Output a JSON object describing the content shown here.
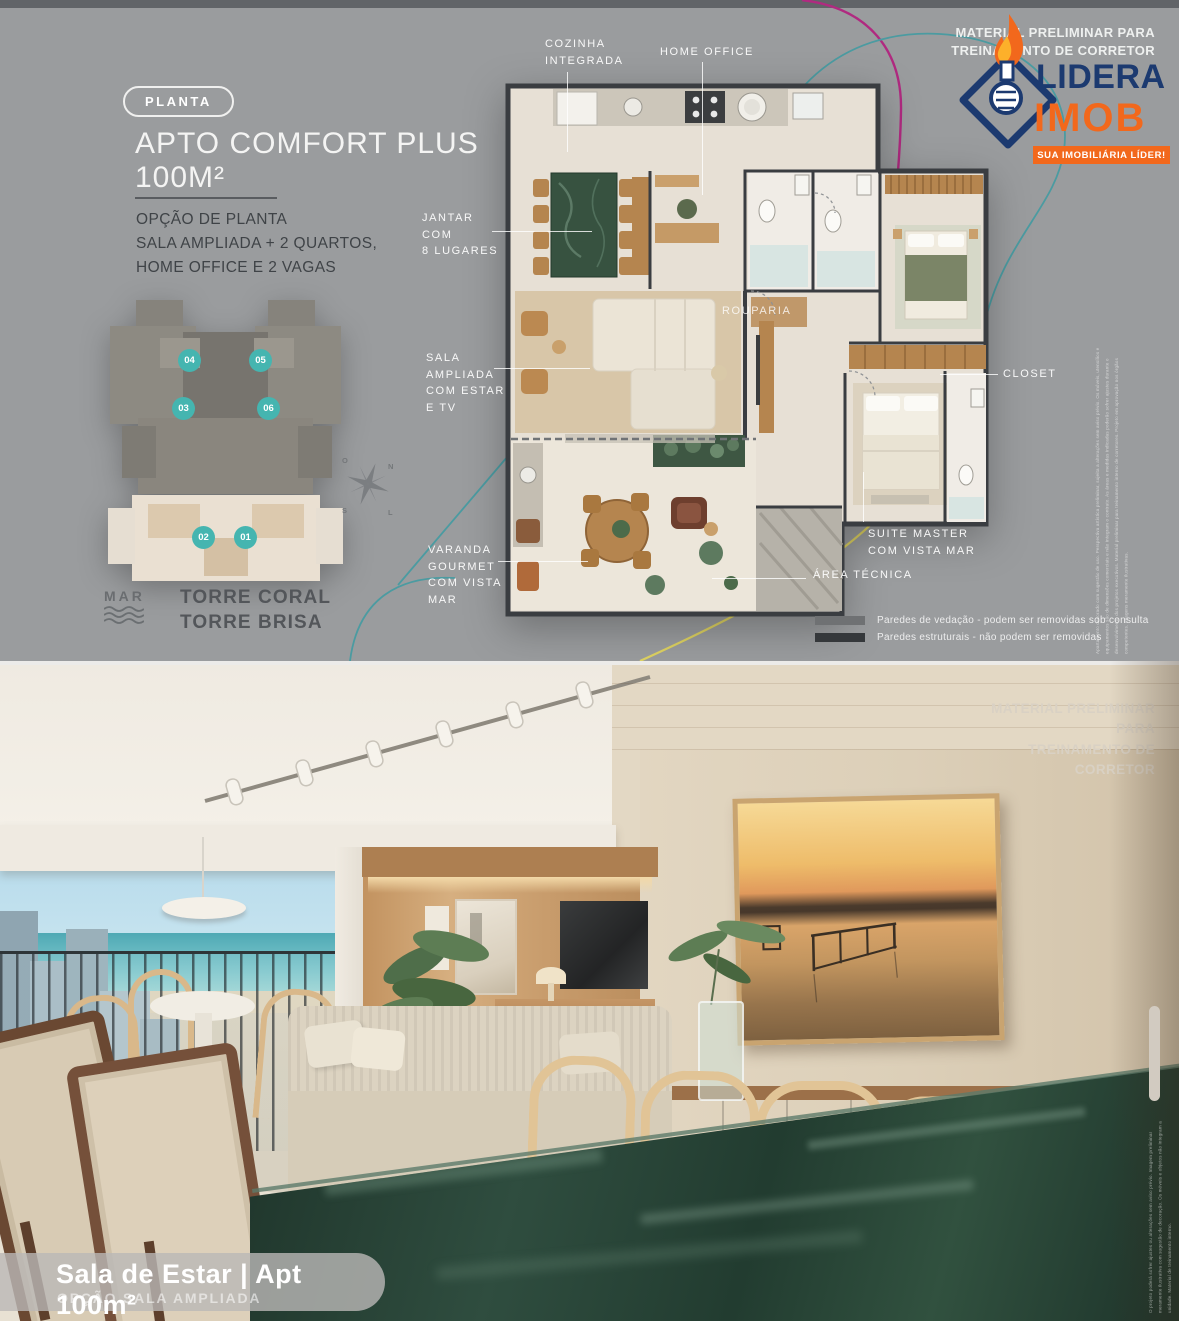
{
  "colors": {
    "background_gray": "#9a9c9e",
    "accent_teal_badge": "#45b5b0",
    "deco_line_teal": "#4b9ba1",
    "deco_line_magenta": "#b02a80",
    "deco_line_yellow": "#ded261",
    "logo_navy": "#1c3a70",
    "logo_orange": "#f2681c",
    "plan_wall_dark": "#3a3d41",
    "marble_green": "#37523f"
  },
  "top": {
    "badge": "PLANTA",
    "title": "APTO COMFORT PLUS",
    "area": "100M²",
    "subtitle": "OPÇÃO DE PLANTA\nSALA AMPLIADA + 2 QUARTOS,\nHOME OFFICE E 2 VAGAS",
    "watermark": "MATERIAL PRELIMINAR PARA\nTREINAMENTO DE CORRETOR",
    "logo": {
      "name_top": "LIDERA",
      "name_bottom": "IMOB",
      "tagline": "SUA IMOBILIÁRIA LÍDER!"
    },
    "tower": {
      "mar": "MAR",
      "names": "TORRE CORAL\nTORRE BRISA",
      "units": [
        "04",
        "05",
        "03",
        "06",
        "02",
        "01"
      ],
      "badge_color": "#45b5b0"
    },
    "compass": {
      "n": "N",
      "s": "S",
      "l": "L",
      "o": "O"
    },
    "plan_labels": {
      "cozinha": "COZINHA\nINTEGRADA",
      "home_office": "HOME OFFICE",
      "jantar": "JANTAR\nCOM\n8 LUGARES",
      "sala": "SALA\nAMPLIADA\nCOM ESTAR\nE TV",
      "varanda": "VARANDA\nGOURMET\nCOM VISTA\nMAR",
      "rouparia": "ROUPARIA",
      "closet": "CLOSET",
      "suite": "SUITE MASTER\nCOM VISTA MAR",
      "area_tecnica": "ÁREA TÉCNICA"
    },
    "legend": [
      {
        "color": "#6f7173",
        "text": "Paredes de vedação - podem ser removidas sob consulta"
      },
      {
        "color": "#35383b",
        "text": "Paredes estruturais - não podem ser removidas"
      }
    ],
    "fine_print": "Apartamento decorado com sugestão de uso. Perspectiva artística preliminar, sujeita a alterações sem aviso prévio. Os móveis, utensílios e equipamentos são de dimensões comerciais e não integram o contrato. As áreas e medidas indicadas poderão sofrer ajustes durante o desenvolvimento dos projetos executivos. Material preliminar para treinamento interno de corretores. Projeto em aprovação nos órgãos competentes. Imagens meramente ilustrativas."
  },
  "bottom": {
    "watermark": "MATERIAL PRELIMINAR PARA\nTREINAMENTO DE CORRETOR",
    "caption": {
      "title": "Sala de Estar |  Apt 100m²",
      "subtitle": "OPÇÃO SALA AMPLIADA"
    },
    "fine_print": "O projeto poderá sofrer ajustes ou alterações sem aviso prévio. Imagem preliminar meramente ilustrativa com sugestão de decoração. Os móveis e objetos não integram a unidade. Material de treinamento interno."
  }
}
